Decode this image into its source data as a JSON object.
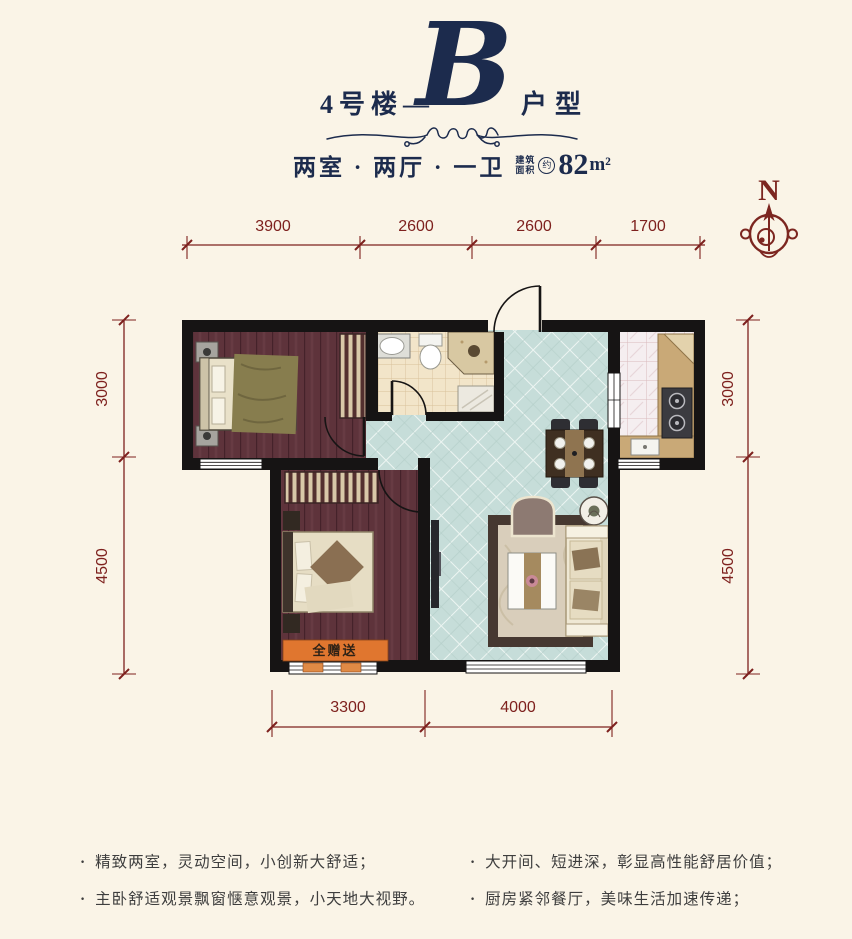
{
  "header": {
    "building_label": "4号楼",
    "dash": "—",
    "type_letter": "B",
    "type_suffix": "户型",
    "layout_label": "两室 · 两厅 · 一卫",
    "area_prefix_line1": "建筑",
    "area_prefix_line2": "面积",
    "area_approx": "约",
    "area_value": "82",
    "area_unit": "m²"
  },
  "compass": {
    "north_label": "N"
  },
  "dimensions": {
    "top": [
      "3900",
      "2600",
      "2600",
      "1700"
    ],
    "left": [
      "3000",
      "4500"
    ],
    "right": [
      "3000",
      "4500"
    ],
    "bottom": [
      "3300",
      "4000"
    ]
  },
  "plan": {
    "bay_window_label": "全赠送"
  },
  "features": {
    "bullet": "·",
    "left": [
      "精致两室，灵动空间，小创新大舒适；",
      "主卧舒适观景飘窗惬意观景，小天地大视野。"
    ],
    "right": [
      "大开间、短进深，彰显高性能舒居价值；",
      "厨房紧邻餐厅，美味生活加速传递；"
    ]
  },
  "colors": {
    "background": "#FAF4E7",
    "title_navy": "#1C2B4D",
    "dimension_maroon": "#7E211E",
    "wall_black": "#161414",
    "tile_teal": "#C6DDD9",
    "wood_maroon": "#5E333B",
    "bay_orange": "#E0762F"
  }
}
